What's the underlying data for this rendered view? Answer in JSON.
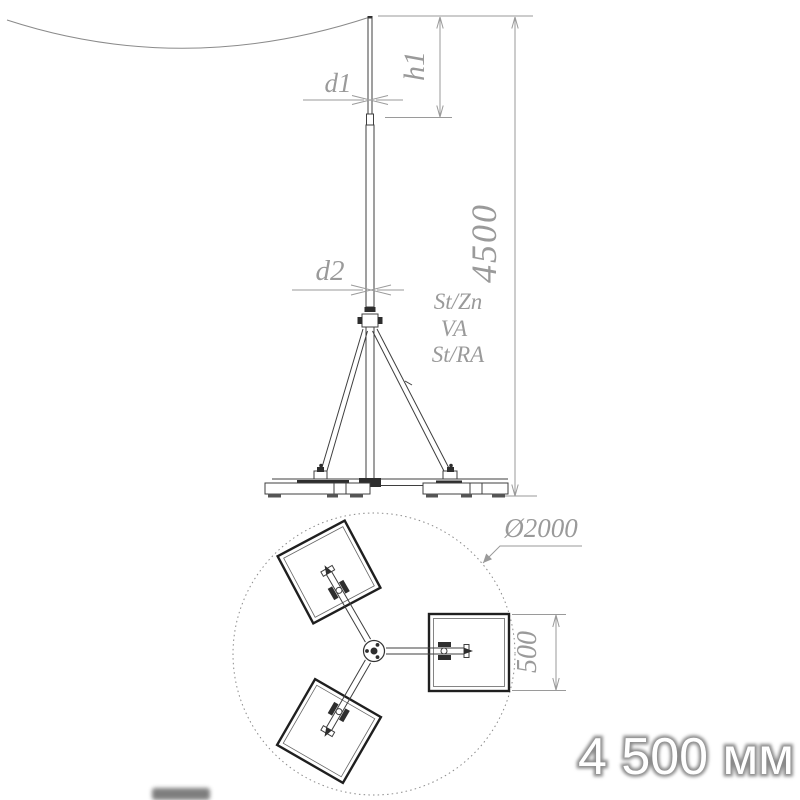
{
  "side_view": {
    "dim_d1": "d1",
    "dim_h1": "h1",
    "dim_d2": "d2",
    "dim_total_height": "4500",
    "materials": [
      "St/Zn",
      "VA",
      "St/RA"
    ]
  },
  "top_view": {
    "dim_base_diameter": "Ø2000",
    "dim_plate_size": "500"
  },
  "caption": {
    "text": "4 500 мм"
  },
  "colors": {
    "drawing_line": "#3f3f3f",
    "dimension_gray": "#9a9a9a",
    "caption_fill": "#ffffff",
    "caption_outline": "#8a8a8a"
  }
}
